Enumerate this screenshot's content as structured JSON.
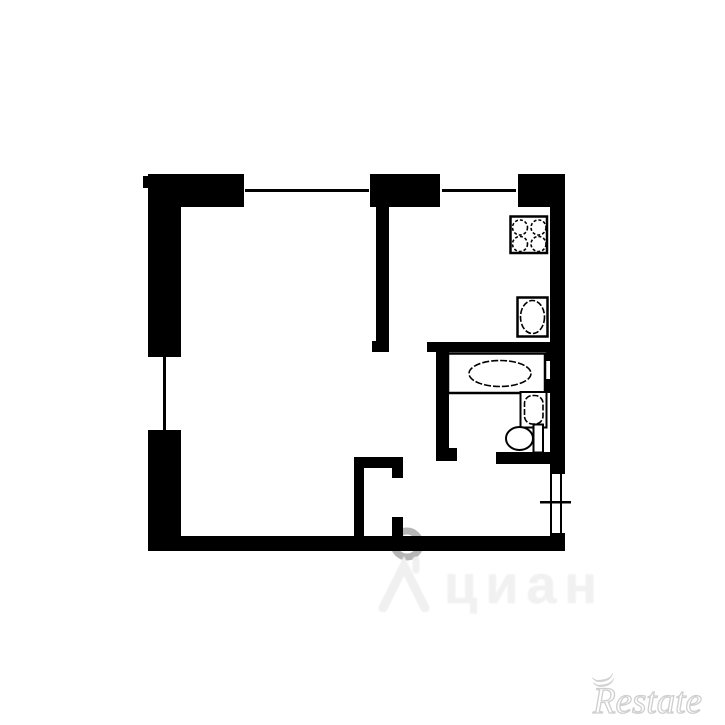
{
  "watermarks": {
    "center": {
      "text": "циан",
      "icon": "house-roof-icon",
      "color": "#f1f1f1"
    },
    "corner": {
      "text": "Restate",
      "color": "#cfcfcf"
    }
  },
  "colors": {
    "wall": "#000000",
    "background": "#ffffff",
    "fixture_fill": "#ffffff",
    "watermark_ring": "#6e6e6e"
  },
  "floor_plan": {
    "type": "apartment-floor-plan",
    "rooms": [
      "living-room",
      "kitchen",
      "bathroom",
      "hallway",
      "closet"
    ],
    "fixtures": [
      "stove-4-burner",
      "kitchen-sink",
      "bathtub",
      "washbasin",
      "toilet"
    ],
    "windows": [
      "top-window-living-room",
      "top-window-kitchen",
      "left-window-living-room"
    ],
    "doors": [
      "entrance-door-right-wall",
      "closet-door",
      "bathroom-door",
      "kitchen-opening"
    ]
  }
}
